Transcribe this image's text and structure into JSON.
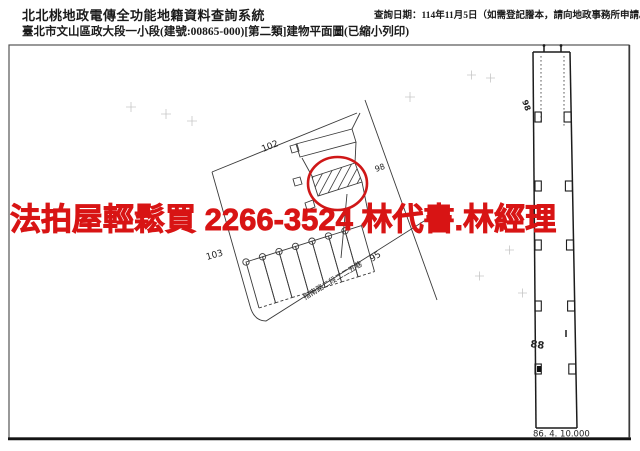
{
  "header": {
    "system_title": "北北桃地政電傳全功能地籍資料查詢系統",
    "doc_title": "臺北市文山區政大段一小段(建號:00865-000)[第二類]建物平面圖(已縮小列印)",
    "query_date": "查詢日期：114年11月5日（如需登記謄本，請向地政事務所申請。）"
  },
  "overlay": {
    "ad_text": "法拍屋輕鬆買 2266-3524 林代書.林經理",
    "color": "#d81414"
  },
  "plan": {
    "labels": {
      "upper": "102",
      "lower_left": "103",
      "lower_right": "95",
      "right": "98"
    },
    "road_label": "指南路二段二二五巷",
    "strip": {
      "top_label": "98",
      "mid_label": "88",
      "date_scale": "86. 4. 10.000"
    }
  }
}
